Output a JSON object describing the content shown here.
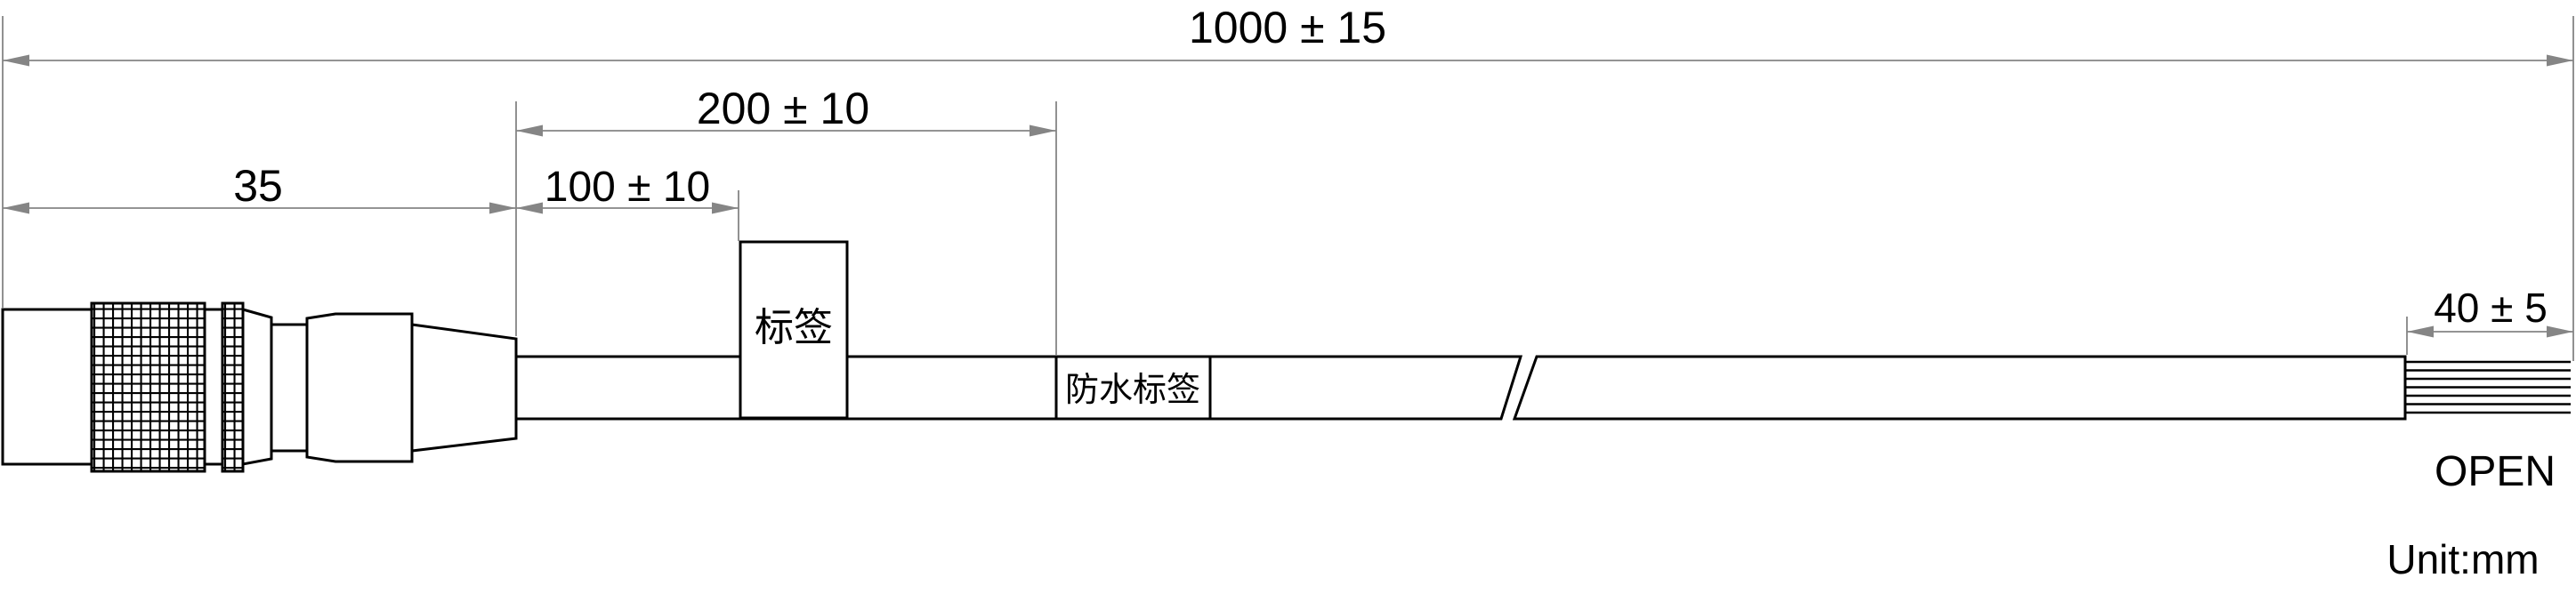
{
  "drawing": {
    "dims": {
      "overall": "1000 ± 15",
      "connector": "35",
      "to_label": "100 ± 10",
      "to_waterproof_label": "200 ± 10",
      "strip": "40 ± 5"
    },
    "tags": {
      "label": "标签",
      "waterproof_label": "防水标签"
    },
    "notes": {
      "cable_end": "OPEN",
      "unit": "Unit:mm"
    },
    "colors": {
      "line": "#000000",
      "dimension": "#858585",
      "background": "#ffffff"
    }
  }
}
